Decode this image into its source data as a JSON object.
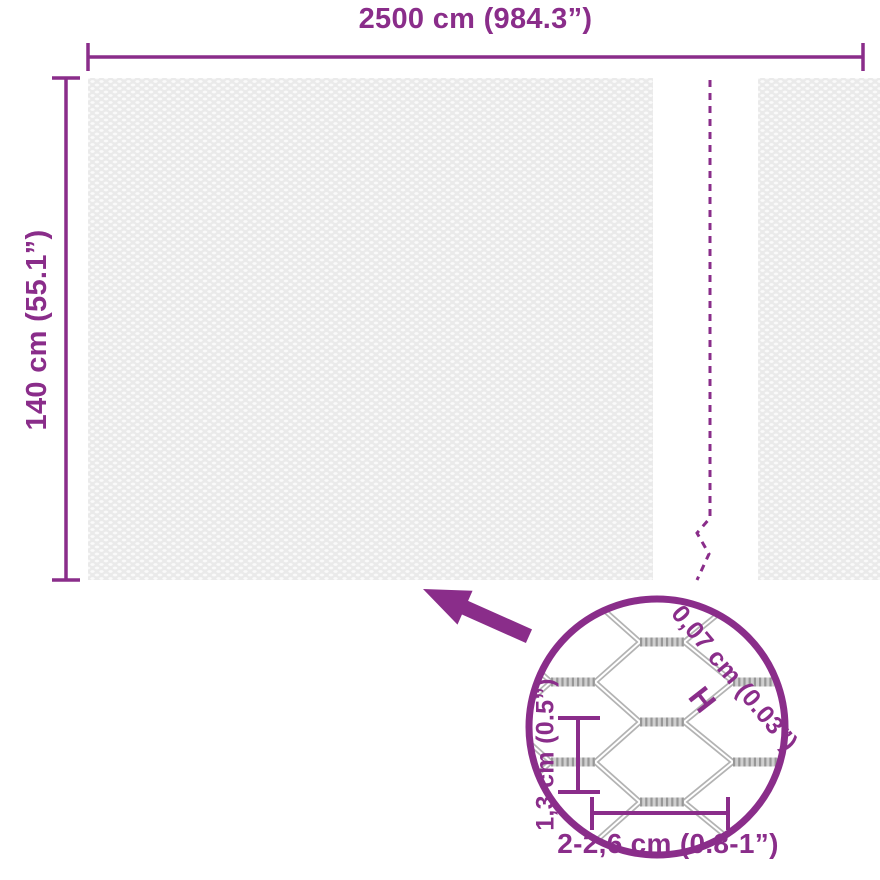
{
  "diagram": {
    "colors": {
      "accent": "#8a2d8a",
      "wire_gray": "#b3b3b3",
      "mesh_fill": "#eaeaea"
    },
    "dimensions": {
      "width_label": "2500 cm (984.3”)",
      "height_label": "140 cm (55.1”)"
    },
    "magnifier": {
      "wire_thickness_label": "0,07 cm (0.03”)",
      "wire_thickness_marker": "H",
      "mesh_height_label": "1,3 cm (0.5”)",
      "mesh_width_label": "2-2,6 cm (0.8-1”)"
    }
  }
}
